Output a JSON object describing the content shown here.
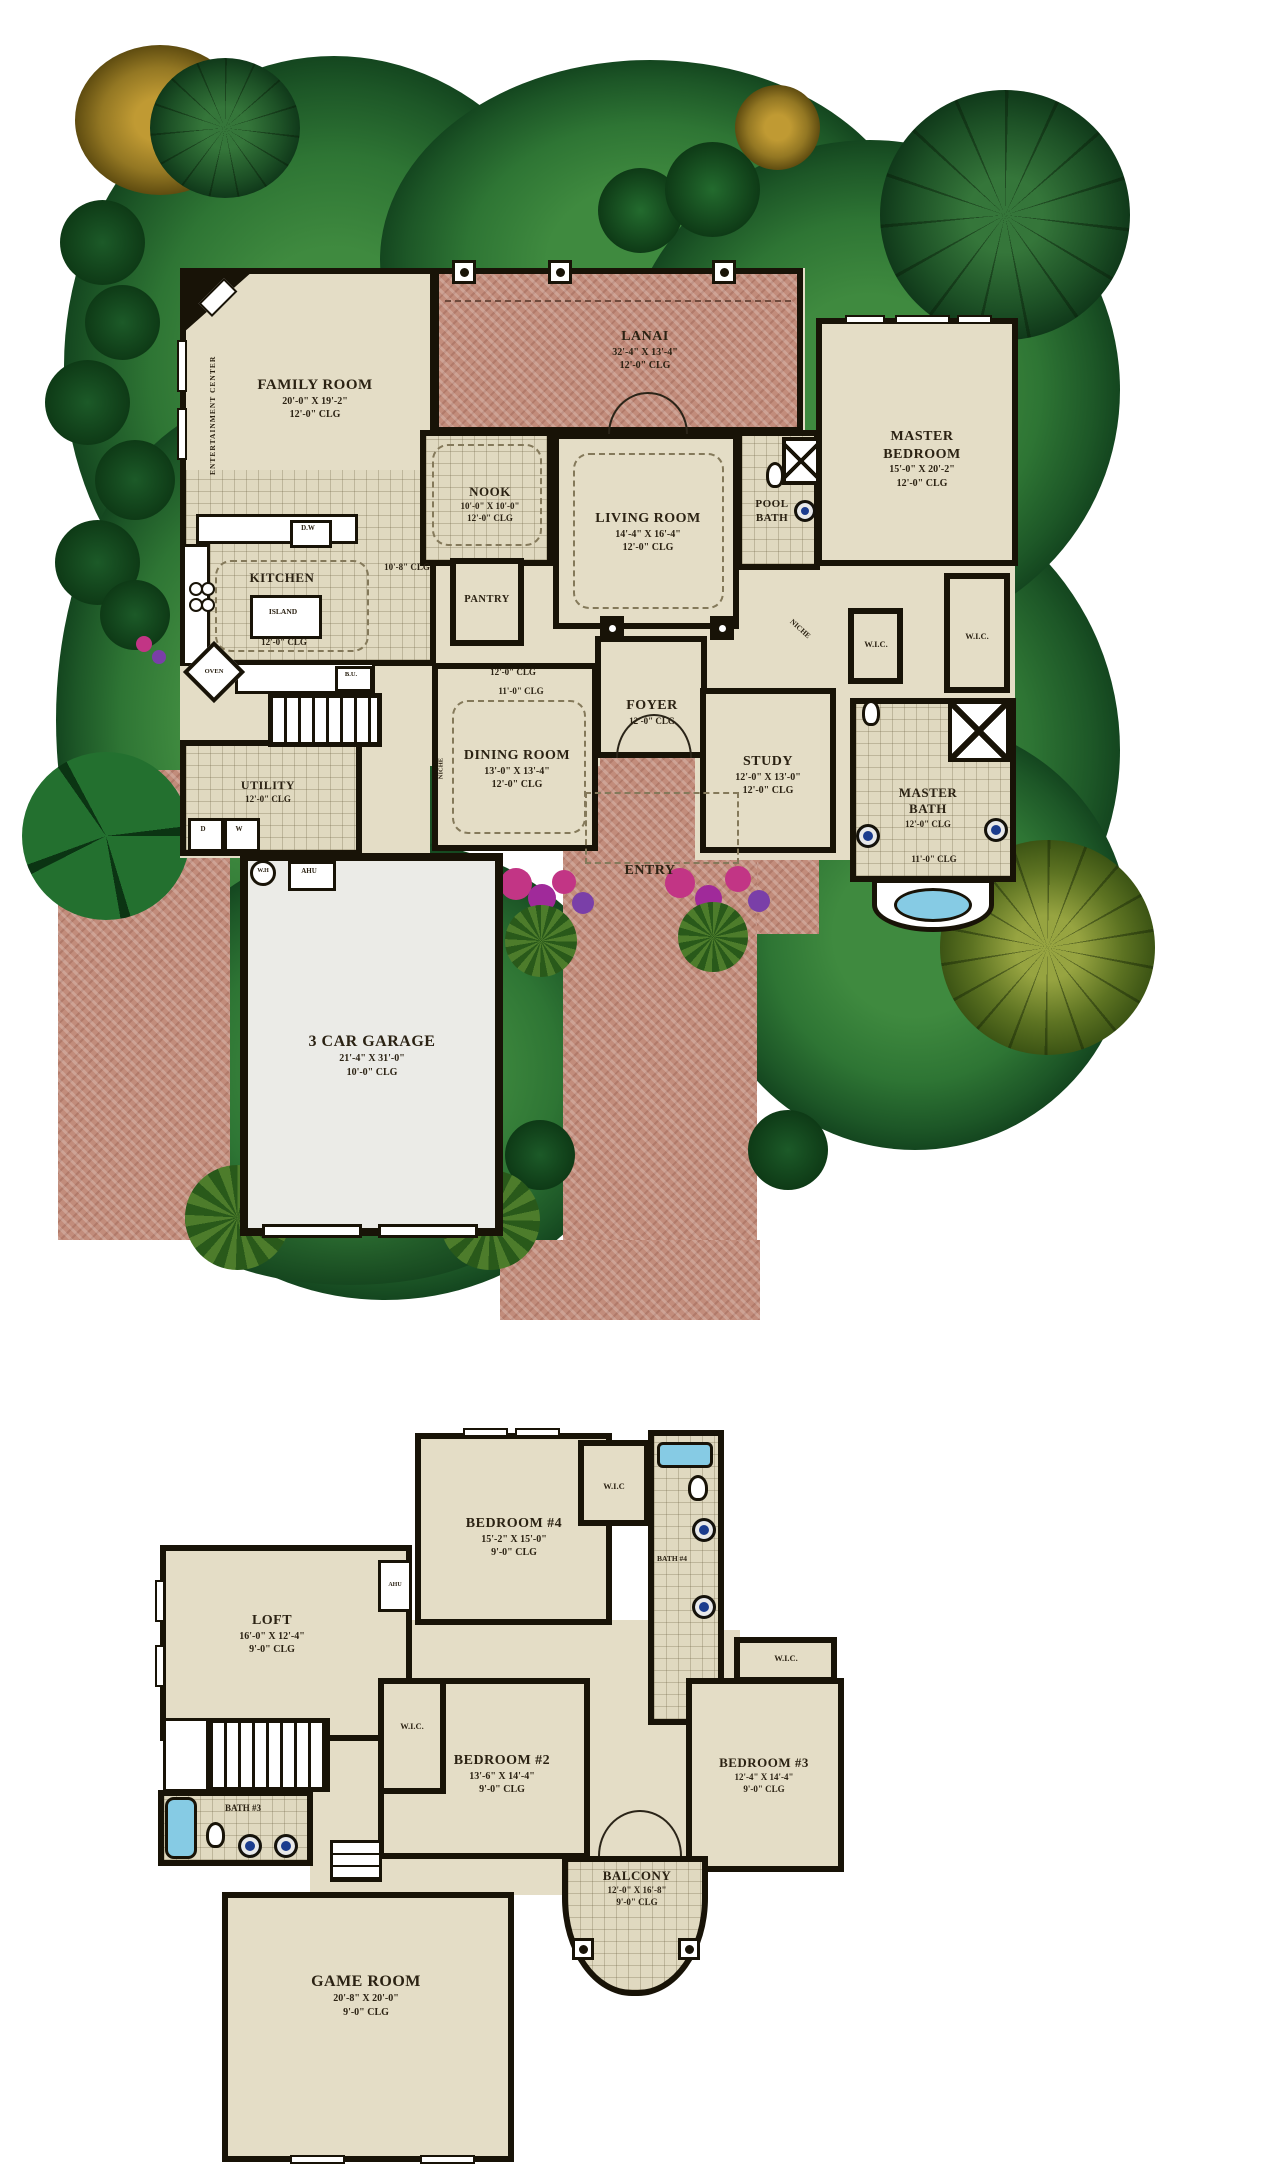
{
  "colors": {
    "wall": "#181307",
    "room_beige": "#e4ddc6",
    "tile": "#e0d9c0",
    "brick": "#c28c7b",
    "grass": "#2e7534",
    "garage": "#ebebe7",
    "tub_blue": "#86cbe4",
    "sink_blue": "#1b3c8e",
    "flower_magenta": "#c23585",
    "flower_purple": "#7a3fa8",
    "flower_red": "#c32020"
  },
  "floor1": {
    "rooms": {
      "family": {
        "name": "FAMILY ROOM",
        "dim": "20'-0\" X 19'-2\"",
        "clg": "12'-0\" CLG"
      },
      "lanai": {
        "name": "LANAI",
        "dim": "32'-4\" X 13'-4\"",
        "clg": "12'-0\" CLG"
      },
      "master_bedroom": {
        "name": "MASTER BEDROOM",
        "dim": "15'-0\" X 20'-2\"",
        "clg": "12'-0\" CLG"
      },
      "nook": {
        "name": "NOOK",
        "dim": "10'-0\" X 10'-0\"",
        "clg": "12'-0\" CLG"
      },
      "living": {
        "name": "LIVING ROOM",
        "dim": "14'-4\" X 16'-4\"",
        "clg": "12'-0\" CLG"
      },
      "kitchen": {
        "name": "KITCHEN",
        "clg": "12'-0\" CLG"
      },
      "pantry": {
        "name": "PANTRY"
      },
      "pool_bath": {
        "name": "POOL BATH"
      },
      "dining": {
        "name": "DINING ROOM",
        "dim": "13'-0\" X 13'-4\"",
        "clg": "12'-0\" CLG"
      },
      "foyer": {
        "name": "FOYER",
        "clg": "12'-0\" CLG"
      },
      "study": {
        "name": "STUDY",
        "dim": "12'-0\" X 13'-0\"",
        "clg": "12'-0\" CLG"
      },
      "utility": {
        "name": "UTILITY",
        "clg": "12'-0\" CLG"
      },
      "master_bath": {
        "name": "MASTER BATH",
        "clg": "12'-0\" CLG",
        "clg2": "11'-0\" CLG"
      },
      "garage": {
        "name": "3 CAR GARAGE",
        "dim": "21'-4\" X 31'-0\"",
        "clg": "10'-0\" CLG"
      },
      "entry": {
        "name": "ENTRY"
      }
    },
    "labels": {
      "entertainment_center": "ENTERTAINMENT CENTER",
      "island": "ISLAND",
      "oven": "OVEN",
      "dw": "D.W",
      "bu": "B.U.",
      "wh": "W.H",
      "ahu": "AHU",
      "niche": "NICHE",
      "niche2": "NICHE",
      "wic": "W.I.C.",
      "wic2": "W.I.C.",
      "hall_clg": "10'-8\" CLG",
      "dining_hall_clg": "12'-0\" CLG",
      "dining_hall_clg2": "11'-0\" CLG",
      "dryer": "D",
      "washer": "W"
    }
  },
  "floor2": {
    "rooms": {
      "bedroom4": {
        "name": "BEDROOM #4",
        "dim": "15'-2\" X 15'-0\"",
        "clg": "9'-0\" CLG"
      },
      "bath4": {
        "name": "BATH #4"
      },
      "loft": {
        "name": "LOFT",
        "dim": "16'-0\" X 12'-4\"",
        "clg": "9'-0\" CLG"
      },
      "bedroom2": {
        "name": "BEDROOM #2",
        "dim": "13'-6\" X 14'-4\"",
        "clg": "9'-0\" CLG"
      },
      "bedroom3": {
        "name": "BEDROOM #3",
        "dim": "12'-4\" X 14'-4\"",
        "clg": "9'-0\" CLG"
      },
      "balcony": {
        "name": "BALCONY",
        "dim": "12'-0\" X 16'-8\"",
        "clg": "9'-0\" CLG"
      },
      "bath3": {
        "name": "BATH #3"
      },
      "game": {
        "name": "GAME ROOM",
        "dim": "20'-8\" X 20'-0\"",
        "clg": "9'-0\" CLG"
      }
    },
    "labels": {
      "wic_b4": "W.I.C",
      "wic_b2": "W.I.C.",
      "wic_b3": "W.I.C.",
      "ahu": "AHU"
    }
  }
}
